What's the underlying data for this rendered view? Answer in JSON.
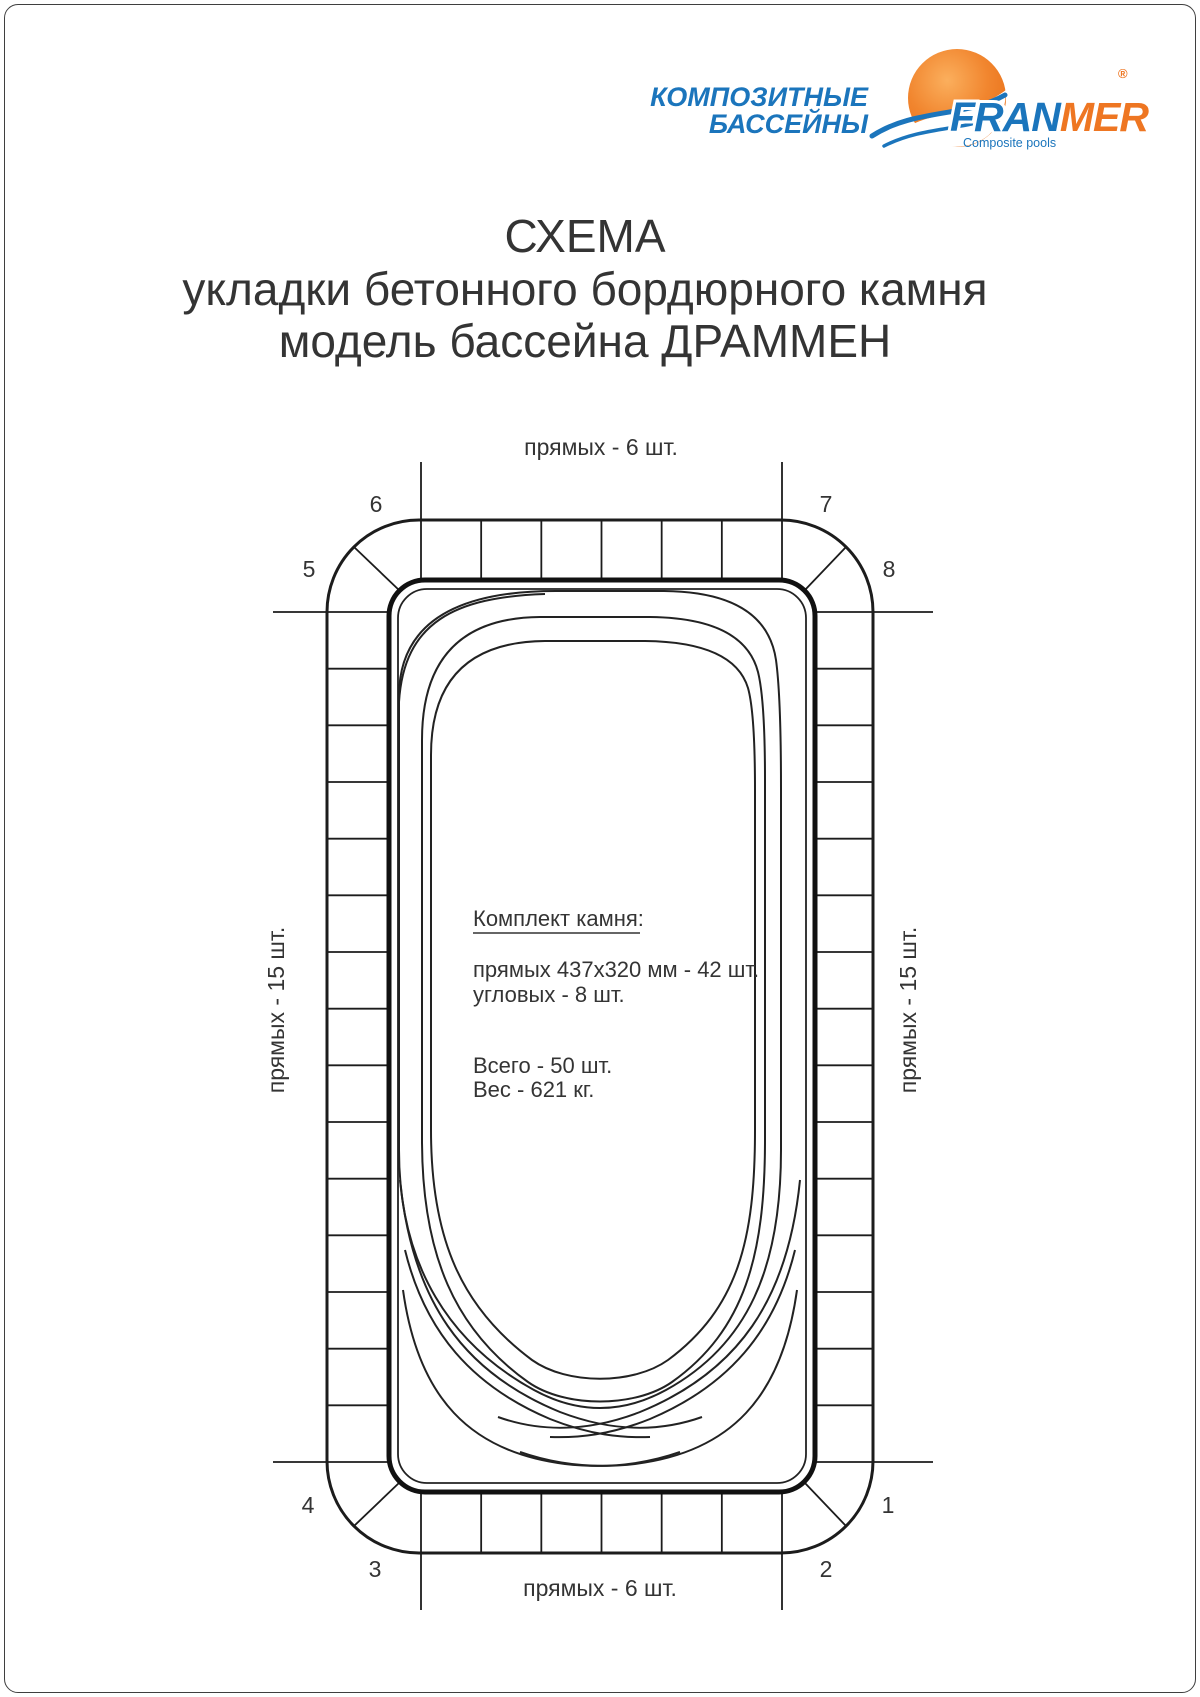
{
  "page": {
    "background": "#ffffff"
  },
  "logo": {
    "brand_line1": "КОМПОЗИТНЫЕ",
    "brand_line2": "БАССЕЙНЫ",
    "name_blue": "FRAN",
    "name_orange": "MER",
    "registered": "®",
    "tagline": "Composite pools",
    "blue": "#1b75bc",
    "orange": "#ee7622"
  },
  "title": {
    "line1": "СХЕМА",
    "line2": "укладки бетонного бордюрного камня",
    "line3": "модель бассейна ДРАММЕН"
  },
  "diagram": {
    "top_label": "прямых - 6 шт.",
    "bottom_label": "прямых - 6 шт.",
    "left_label": "прямых - 15 шт.",
    "right_label": "прямых - 15 шт.",
    "corner_numbers": {
      "n1": "1",
      "n2": "2",
      "n3": "3",
      "n4": "4",
      "n5": "5",
      "n6": "6",
      "n7": "7",
      "n8": "8"
    },
    "spec": {
      "heading": "Комплект камня:",
      "straight": "прямых 437х320 мм - 42 шт.",
      "corner": "угловых - 8 шт.",
      "total": "Всего - 50 шт.",
      "weight": "Вес - 621 кг."
    }
  }
}
